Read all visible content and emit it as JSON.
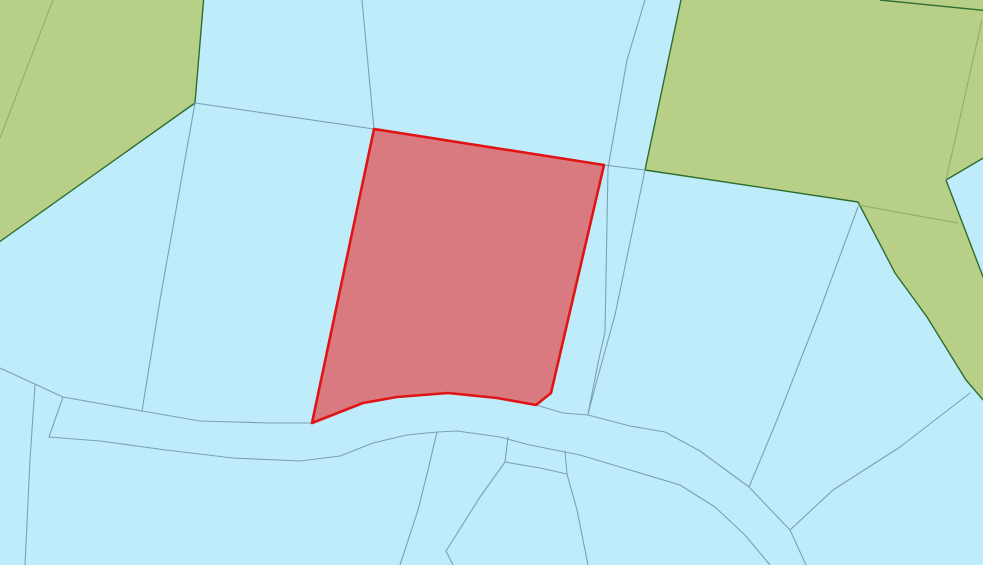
{
  "map": {
    "kind": "cadastral-parcel-map",
    "canvas": {
      "width": 983,
      "height": 565
    },
    "colors": {
      "background": "#bfecfb",
      "parcel_line": "#7ba1b3",
      "vegetation_fill": "#b7cf86",
      "vegetation_outline": "#2c6e2e",
      "vegetation_inner_line": "#8ca96c",
      "selected_fill": "#d97a80",
      "selected_outline": "#e01414"
    },
    "vegetation_parcels": [
      {
        "id": "vegetation-parcel-northwest",
        "points": "-5,-5 204,-5 195,103 -5,245"
      },
      {
        "id": "vegetation-parcel-northeast",
        "points": "682,-5 990,-5 990,154 946,180 990,295 990,408 966,380 927,317 895,273 858,202 645,170"
      }
    ],
    "vegetation_outline_lines": [
      "880,0 990,11"
    ],
    "vegetation_inner_lines": [
      "53,0 0,138",
      "982,20 946,180",
      "858,205 958,223"
    ],
    "parcel_lines": [
      "195,103 374,129",
      "195,103 160,300 142,411",
      "362,0 374,129",
      "645,0 627,60 608,168 605,332 598,363 588,414",
      "645,170 615,315 597,380 588,414",
      "604,165 645,170",
      "0,368 63,397 142,411 200,421 270,423 311,423",
      "536,405 563,413 588,415 630,426 665,432 700,451 749,487 790,530 806,565",
      "49,437 100,441 166,450 233,458 300,461 340,456 373,443 407,435 437,432 457,431 500,437 530,445 580,455 630,470 680,485 715,507 745,535 770,565",
      "63,397 49,437",
      "35,385 30,460 25,565",
      "437,432 428,470 418,510 400,565",
      "508,437 505,462 480,497 458,532 446,551 453,565",
      "505,462 540,468 567,474",
      "565,451 567,474",
      "567,474 577,510 584,545 588,565",
      "970,393 900,447 833,490 790,530",
      "858,207 820,310 777,420 749,487"
    ],
    "selected_parcel": {
      "id": "selected-parcel",
      "points": "374,129 604,165 551,393 536,405 497,398 448,393 397,397 363,403 312,423"
    }
  }
}
